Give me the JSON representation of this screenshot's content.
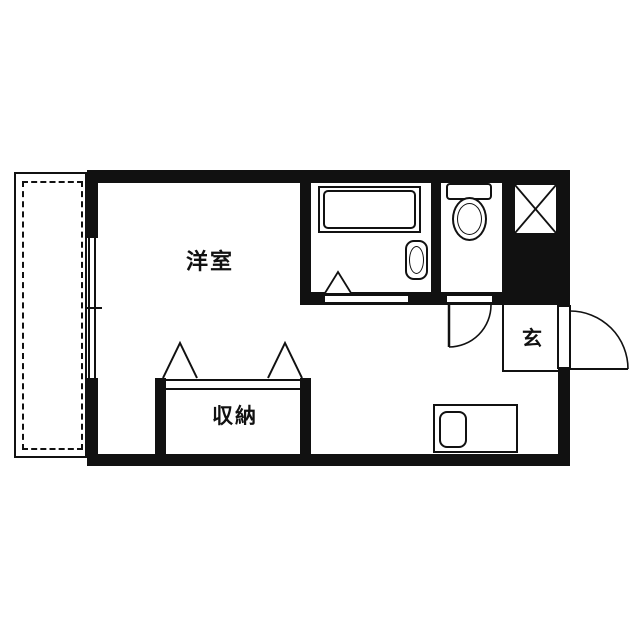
{
  "floor_plan": {
    "labels": {
      "living_room": "洋室",
      "closet": "収納",
      "entrance": "玄"
    },
    "fixtures": [
      "balcony",
      "sliding-window",
      "bathtub",
      "washbasin",
      "folding-door",
      "toilet",
      "utility-shaft-x-box",
      "entrance-door",
      "toilet-door",
      "kitchen-counter",
      "kitchen-sink",
      "closet-doors"
    ],
    "colors": {
      "wall": "#111111",
      "background": "#ffffff"
    }
  }
}
